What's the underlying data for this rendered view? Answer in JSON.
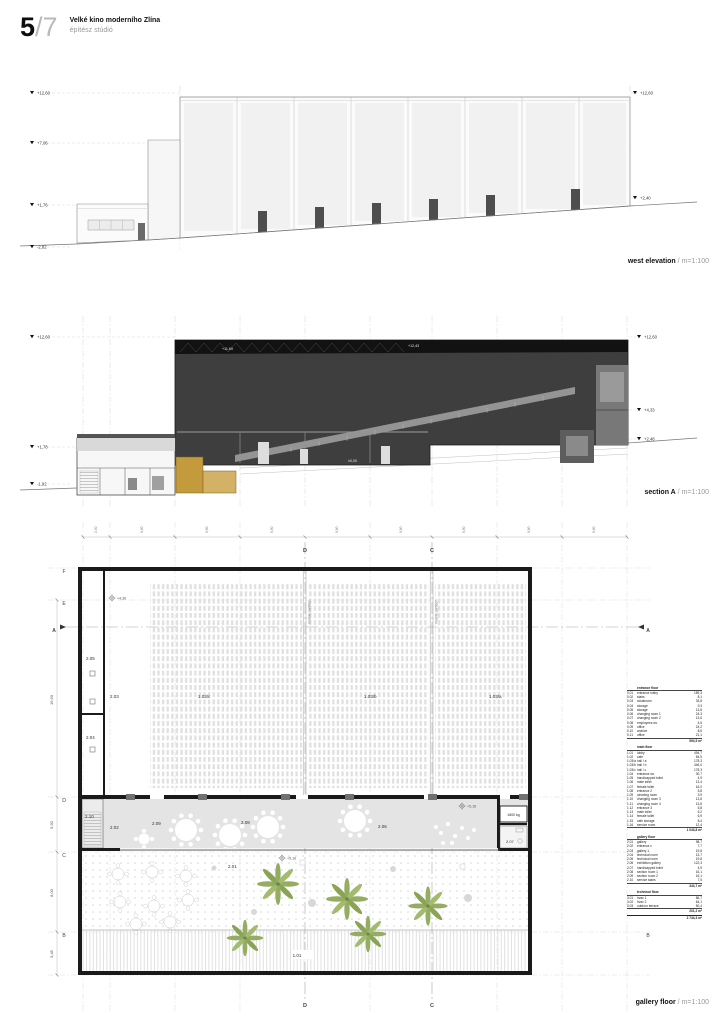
{
  "header": {
    "num": "5",
    "total": "/7",
    "title": "Velké kino moderního Zlína",
    "subtitle": "építész stúdió"
  },
  "west": {
    "name": "west elevation",
    "scale": "/ m=1:100",
    "ml": [
      "+12,60",
      "+7,06",
      "+1,76",
      "-2,82"
    ],
    "mr": [
      "+12,60",
      "+2,40"
    ]
  },
  "section": {
    "name": "section A",
    "scale": "/ m=1:100",
    "ml": [
      "+12,60",
      "+1,78",
      "-1,92"
    ],
    "mr": [
      "+12,60",
      "+4,33",
      "+2,48"
    ],
    "inner": [
      "+11,69",
      "+12,43",
      "±0,00"
    ]
  },
  "plan": {
    "name": "gallery floor",
    "scale": "/ m=1:100",
    "partition": "mobile partition",
    "lift": "1600 kg",
    "levels": {
      "hall": "+4,36",
      "foyer": "+5,16",
      "terrace": "+5,16"
    },
    "rooms": {
      "r205": "2.05",
      "r203": "2.03",
      "r204": "2.04",
      "hc": "1.03/c",
      "hb": "1.03/b",
      "ha": "1.03/a",
      "r210": "2.10",
      "r202": "2.02",
      "r209": "2.09",
      "r208": "2.08",
      "r206": "2.06",
      "r207": "2.07",
      "r201": "2.01",
      "r101": "1.01"
    },
    "grid": {
      "top": [
        "D",
        "C"
      ],
      "bottom": [
        "D",
        "C"
      ],
      "left": [
        "F",
        "E",
        "D",
        "C",
        "B"
      ],
      "right": [
        "A",
        "B"
      ],
      "a": "A"
    },
    "dims_left": [
      "16,90",
      "5,90",
      "8,00",
      "3,45"
    ],
    "dims_top": [
      "2,30",
      "9,90",
      "9,90",
      "9,90",
      "9,90",
      "9,90",
      "9,90",
      "9,90",
      "9,90"
    ]
  },
  "schedule": {
    "rows": [
      {
        "c": "head",
        "nm": "entrance floor"
      },
      {
        "c": "row",
        "n": "0.01",
        "nm": "entrance lobby",
        "a": "189,3"
      },
      {
        "c": "row",
        "n": "0.02",
        "nm": "stairs",
        "a": "8,1"
      },
      {
        "c": "row",
        "n": "0.03",
        "nm": "cloakroom",
        "a": "33,8"
      },
      {
        "c": "row",
        "n": "0.04",
        "nm": "storage",
        "a": "9,3"
      },
      {
        "c": "row",
        "n": "0.05",
        "nm": "storage",
        "a": "13,8"
      },
      {
        "c": "row",
        "n": "0.06",
        "nm": "changing room 1",
        "a": "24,3"
      },
      {
        "c": "row",
        "n": "0.07",
        "nm": "changing room 2",
        "a": "13,6"
      },
      {
        "c": "row",
        "n": "0.08",
        "nm": "employees wc",
        "a": "4,5"
      },
      {
        "c": "row",
        "n": "0.09",
        "nm": "office",
        "a": "24,2"
      },
      {
        "c": "row",
        "n": "0.10",
        "nm": "archive",
        "a": "8,6"
      },
      {
        "c": "row",
        "n": "0.11",
        "nm": "office",
        "a": "21,1"
      },
      {
        "c": "sub",
        "nm": "",
        "a": "594,5 m²"
      },
      {
        "c": "head",
        "nm": "main floor"
      },
      {
        "c": "row",
        "n": "1.01",
        "nm": "lobby",
        "a": "494,7"
      },
      {
        "c": "row",
        "n": "1.02",
        "nm": "cafe",
        "a": "84,5"
      },
      {
        "c": "row",
        "n": "1.03/a",
        "nm": "hall / a",
        "a": "178,3"
      },
      {
        "c": "row",
        "n": "1.03/b",
        "nm": "hall / b",
        "a": "446,0"
      },
      {
        "c": "row",
        "n": "1.03/c",
        "nm": "hall / c",
        "a": "178,3"
      },
      {
        "c": "row",
        "n": "1.04",
        "nm": "entrance wc",
        "a": "30,7"
      },
      {
        "c": "row",
        "n": "1.05",
        "nm": "handicapped toilet",
        "a": "4,9"
      },
      {
        "c": "row",
        "n": "1.06",
        "nm": "male toilet",
        "a": "13,4"
      },
      {
        "c": "row",
        "n": "1.07",
        "nm": "female toilet",
        "a": "16,0"
      },
      {
        "c": "row",
        "n": "1.08",
        "nm": "entrance 2",
        "a": "5,8"
      },
      {
        "c": "row",
        "n": "1.09",
        "nm": "cleaning room",
        "a": "3,9"
      },
      {
        "c": "row",
        "n": "1.10",
        "nm": "changing room 3",
        "a": "13,8"
      },
      {
        "c": "row",
        "n": "1.11",
        "nm": "changing room 4",
        "a": "13,8"
      },
      {
        "c": "row",
        "n": "1.12",
        "nm": "entrance 3",
        "a": "5,8"
      },
      {
        "c": "row",
        "n": "1.13",
        "nm": "male toilet",
        "a": "6,2"
      },
      {
        "c": "row",
        "n": "1.14",
        "nm": "female toilet",
        "a": "6,9"
      },
      {
        "c": "row",
        "n": "1.15",
        "nm": "cafe storage",
        "a": "8,4"
      },
      {
        "c": "row",
        "n": "1.16",
        "nm": "service room",
        "a": "12,4"
      },
      {
        "c": "sub",
        "nm": "",
        "a": "1 043,8 m²"
      },
      {
        "c": "head",
        "nm": "gallery floor"
      },
      {
        "c": "row",
        "n": "2.01",
        "nm": "gallery",
        "a": "98,7"
      },
      {
        "c": "row",
        "n": "2.02",
        "nm": "entrance c",
        "a": "7,7"
      },
      {
        "c": "row",
        "n": "2.03",
        "nm": "gallery 1",
        "a": "19,8"
      },
      {
        "c": "row",
        "n": "2.04",
        "nm": "technical room",
        "a": "13,7"
      },
      {
        "c": "row",
        "n": "2.05",
        "nm": "technical room",
        "a": "19,8"
      },
      {
        "c": "row",
        "n": "2.06",
        "nm": "exhibition gallery",
        "a": "122,3"
      },
      {
        "c": "row",
        "n": "2.07",
        "nm": "handicapped toilet",
        "a": "4,9"
      },
      {
        "c": "row",
        "n": "2.08",
        "nm": "section room 1",
        "a": "16,1"
      },
      {
        "c": "row",
        "n": "2.09",
        "nm": "section room 2",
        "a": "16,1"
      },
      {
        "c": "row",
        "n": "2.10",
        "nm": "service stairs",
        "a": "7,5"
      },
      {
        "c": "sub",
        "nm": "",
        "a": "344,7 m²"
      },
      {
        "c": "head",
        "nm": "technical floor"
      },
      {
        "c": "row",
        "n": "3.01",
        "nm": "hvac 1",
        "a": "86,7"
      },
      {
        "c": "row",
        "n": "3.02",
        "nm": "hvac 2",
        "a": "64,1"
      },
      {
        "c": "row",
        "n": "3.03",
        "nm": "outdoor terrace",
        "a": "50,4"
      },
      {
        "c": "sub",
        "nm": "",
        "a": "201,2 m²"
      },
      {
        "c": "total",
        "nm": "",
        "a": "2 744,3 m²"
      }
    ]
  }
}
